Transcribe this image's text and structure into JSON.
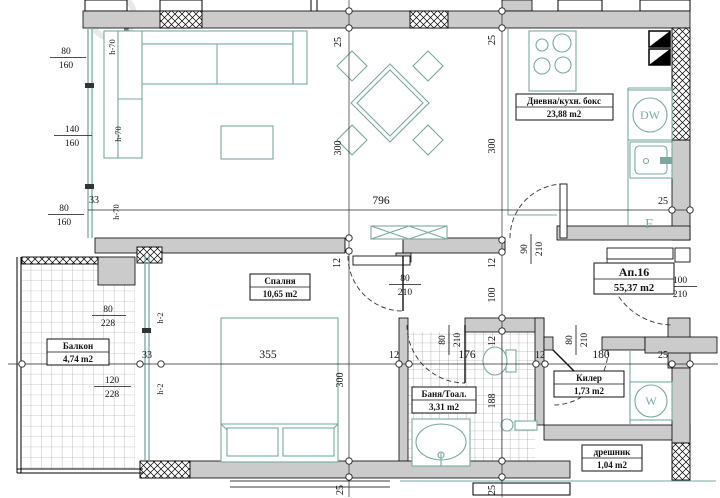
{
  "apartment": {
    "number": "Ап.16",
    "area": "55,37 m2"
  },
  "rooms": {
    "living": {
      "name": "Дневна/кухн. бокс",
      "area": "23,88 m2"
    },
    "bedroom": {
      "name": "Спалня",
      "area": "10,65 m2"
    },
    "balcony": {
      "name": "Балкон",
      "area": "4,74 m2"
    },
    "bath": {
      "name": "Баня/Тоал.",
      "area": "3,31 m2"
    },
    "closet": {
      "name": "Килер",
      "area": "1,73 m2"
    },
    "wardrobe": {
      "name": "дрешник",
      "area": "1,04 m2"
    }
  },
  "appliances": {
    "dishwasher": "DW",
    "washer": "W",
    "fridge": "F"
  },
  "dims": {
    "v796": "796",
    "v355": "355",
    "v300": "300",
    "v150": "150",
    "v176": "176",
    "v188": "188",
    "v180": "180",
    "v140": "140",
    "v160": "160",
    "v120": "120",
    "v100": "100",
    "v228": "228",
    "v210": "210",
    "v90": "90",
    "v80": "80",
    "v33": "33",
    "v25": "25",
    "v12": "12",
    "h70": "h-70",
    "h2": "h-2"
  },
  "colors": {
    "accent_teal": "#79a8a1",
    "wall_gray": "#cbcbcb"
  }
}
